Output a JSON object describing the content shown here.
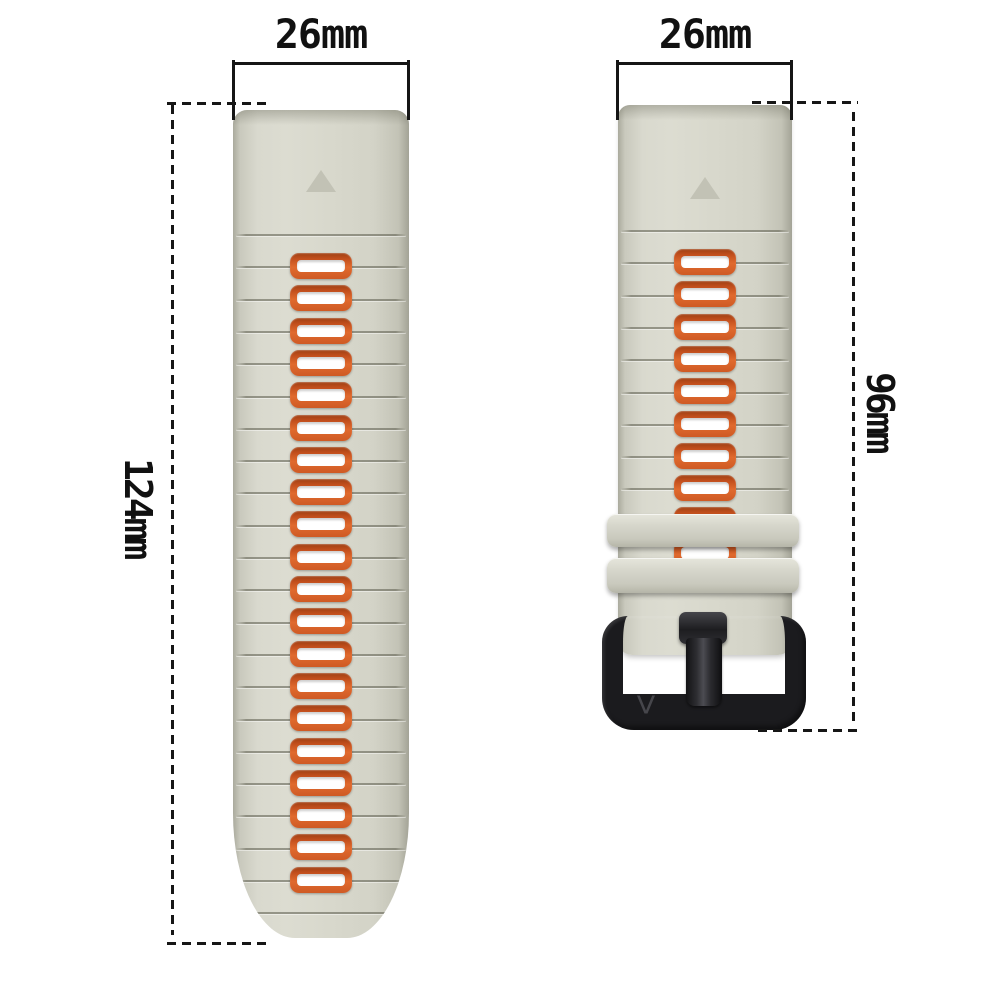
{
  "annotations": {
    "left_strap_width": "26mm",
    "right_strap_width": "26mm",
    "left_strap_length": "124mm",
    "right_strap_length": "96mm"
  },
  "buckle": {
    "logo": "V"
  },
  "left_strap": {
    "hole_count": 20,
    "groove_count": 22
  },
  "right_strap": {
    "hole_count": 10,
    "groove_count": 9,
    "keeper_count": 2
  },
  "colors": {
    "background": "#ffffff",
    "strap": "#d8d8cc",
    "strap_edge": "#a8a89b",
    "hole_frame_orange": "#d85c28",
    "hole_frame_orange_dark": "#9e3f12",
    "hole_center": "#ffffff",
    "buckle_black": "#1b1b1e",
    "dimension_ink": "#151515"
  }
}
